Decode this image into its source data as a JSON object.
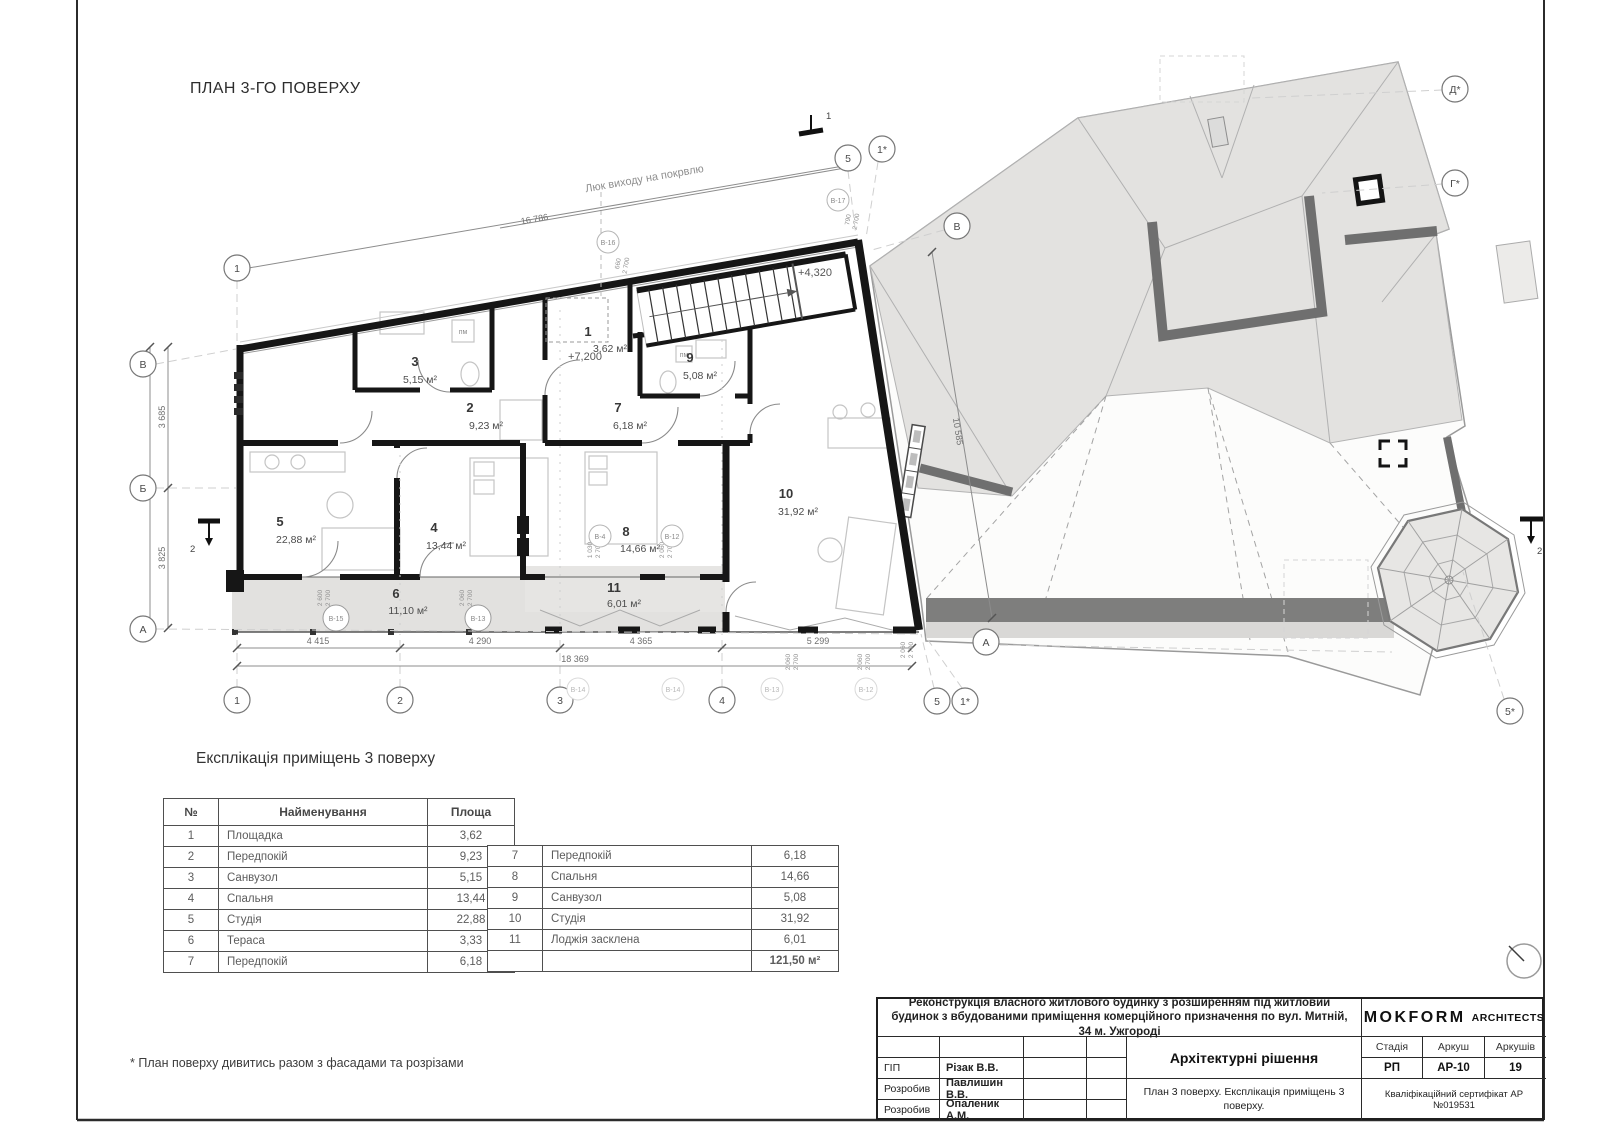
{
  "sheet": {
    "title": "ПЛАН 3-ГО ПОВЕРХУ",
    "footnote": "* План поверху дивитись разом з фасадами та розрізами"
  },
  "plan": {
    "rooms": {
      "r1": {
        "n": "1",
        "a": "3,62 м²"
      },
      "r2": {
        "n": "2",
        "a": "9,23 м²"
      },
      "r3": {
        "n": "3",
        "a": "5,15 м²"
      },
      "r4": {
        "n": "4",
        "a": "13,44 м²"
      },
      "r5": {
        "n": "5",
        "a": "22,88 м²"
      },
      "r6": {
        "n": "6",
        "a": "11,10 м²"
      },
      "r7": {
        "n": "7",
        "a": "6,18 м²"
      },
      "r8": {
        "n": "8",
        "a": "14,66 м²"
      },
      "r9": {
        "n": "9",
        "a": "5,08 м²"
      },
      "r10": {
        "n": "10",
        "a": "31,92 м²"
      },
      "r11": {
        "n": "11",
        "a": "6,01 м²"
      }
    },
    "levels": {
      "stair": "+4,320",
      "floor": "+7,200"
    },
    "annotations": {
      "luk": "Люк виходу на покрвлю",
      "pm": "пм"
    },
    "dims": {
      "top": "16 786",
      "left1": "3 685",
      "leftTotal": "7 510",
      "left2": "3 825",
      "b1": "4 415",
      "b2": "4 290",
      "b3": "4 365",
      "b4": "5 299",
      "bTotal": "18 369",
      "diag": "10 585",
      "d2600": "2 600",
      "d2700": "2 700",
      "d2060": "2 060",
      "d1030": "1 030",
      "d660": "660",
      "d790": "790"
    },
    "axes": {
      "c1": "1",
      "c2": "2",
      "c3": "3",
      "c4": "4",
      "c5": "5",
      "c1s": "1*",
      "c5s": "5*",
      "rA": "А",
      "rB": "Б",
      "rV": "В",
      "rGs": "Г*",
      "rDs": "Д*"
    },
    "marks": {
      "m4": "В-4",
      "m12": "В-12",
      "m13": "В-13",
      "m14": "В-14",
      "m15": "В-15",
      "m16": "В-16",
      "m17": "В-17"
    },
    "sections": {
      "s1": "1",
      "s2": "2"
    }
  },
  "exploration": {
    "heading": "Експлікація приміщень 3 поверху",
    "columns": [
      "№",
      "Найменування",
      "Площа"
    ],
    "left_rows": [
      [
        "1",
        "Площадка",
        "3,62"
      ],
      [
        "2",
        "Передпокій",
        "9,23"
      ],
      [
        "3",
        "Санвузол",
        "5,15"
      ],
      [
        "4",
        "Спальня",
        "13,44"
      ],
      [
        "5",
        "Студія",
        "22,88"
      ],
      [
        "6",
        "Тераса",
        "3,33"
      ],
      [
        "7",
        "Передпокій",
        "6,18"
      ]
    ],
    "right_rows": [
      [
        "7",
        "Передпокій",
        "6,18"
      ],
      [
        "8",
        "Спальня",
        "14,66"
      ],
      [
        "9",
        "Санвузол",
        "5,08"
      ],
      [
        "10",
        "Студія",
        "31,92"
      ],
      [
        "11",
        "Лоджія засклена",
        "6,01"
      ]
    ],
    "total": "121,50 м²"
  },
  "titleblock": {
    "project": "Реконструкція власного житлового будинку з розширенням під житловий будинок з вбудованими приміщення комерційного призначення по вул. Митній, 34 м. Ужгороді",
    "roles": [
      {
        "label": "ГІП",
        "name": "Різак В.В."
      },
      {
        "label": "Розробив",
        "name": "Павлишин В.В."
      },
      {
        "label": "Розробив",
        "name": "Опаленик А.М."
      }
    ],
    "doc_title": "Архітектурні рішення",
    "doc_subtitle": "План 3 поверху. Експлікація приміщень 3 поверху.",
    "brand": "MOKFORM",
    "brand2": "ARCHITECTS",
    "stage_label": "Стадія",
    "sheet_label": "Аркуш",
    "sheets_label": "Аркушів",
    "stage": "РП",
    "sheet_no": "АР-10",
    "sheets_total": "19",
    "cert": "Кваліфікаційний сертифікат АР №019531"
  }
}
